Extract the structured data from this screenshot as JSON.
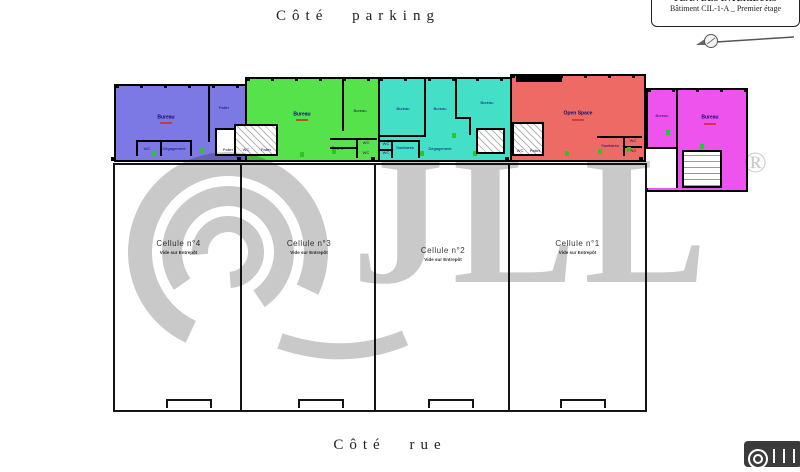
{
  "labels": {
    "parking": "Côté parking",
    "rue": "Côté rue"
  },
  "title_block": {
    "line1": "PLAN DES INTERIEURS",
    "line2": "Bâtiment CIL-1-A _ Premier étage"
  },
  "watermark": {
    "text": "JLL",
    "registered": "®"
  },
  "cellules": [
    {
      "label": "Cellule n°4",
      "sub": "Vide sur Entrepôt"
    },
    {
      "label": "Cellule n°3",
      "sub": "Vide sur Entrepôt"
    },
    {
      "label": "Cellule n°2",
      "sub": "Vide sur Entrepôt"
    },
    {
      "label": "Cellule n°1",
      "sub": "Vide sur Entrepôt"
    }
  ],
  "zones": {
    "purple": {
      "bureau": "Bureau",
      "palier_top": "Palier",
      "wc": "WC",
      "degagement": "Dégagement",
      "palier_bottom": "Palier"
    },
    "green": {
      "bureau_left": "Bureau",
      "bureau_right": "Bureau",
      "wc_left": "WC",
      "palier": "Palier",
      "degagement": "Dégagement",
      "wc_top": "WC",
      "wc_bottom": "WC"
    },
    "teal": {
      "bureau_1": "Bureau",
      "bureau_2": "Bureau",
      "bureau_3": "Bureau",
      "wc_top": "WC",
      "wc_bottom": "WC",
      "sanitaires": "Sanitaires",
      "degagement": "Dégagement",
      "palier": "Palier"
    },
    "red": {
      "open_space": "Open Space",
      "wc": "WC",
      "palier": "Palier",
      "sanitaires": "Sanitaires",
      "wc_1": "WC",
      "wc_2": "WC"
    },
    "pink": {
      "bureau_small": "Bureau",
      "bureau_large": "Bureau"
    }
  },
  "colors": {
    "purple": "#7c79e4",
    "green": "#55e24b",
    "teal": "#43dfc6",
    "red": "#ee6a64",
    "pink": "#ee53ee",
    "watermark_gray": "#c9c9c9"
  }
}
